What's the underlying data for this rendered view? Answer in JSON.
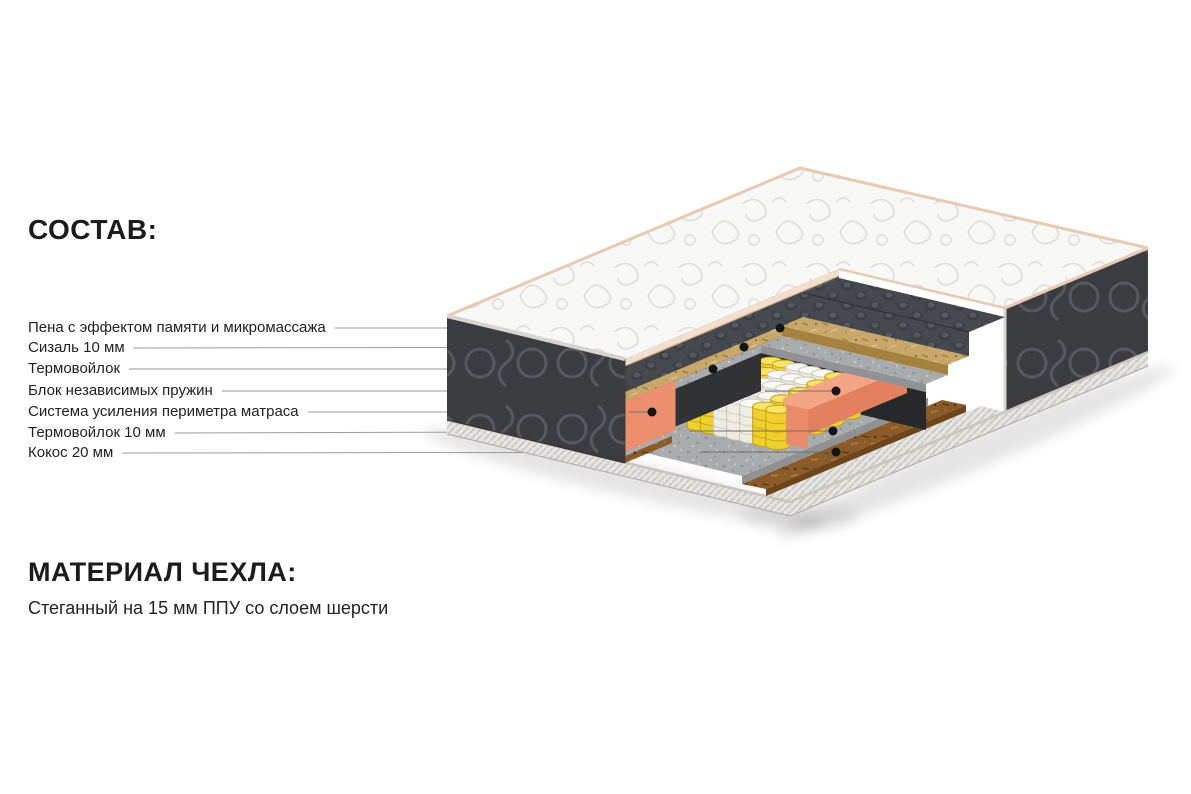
{
  "composition": {
    "title": "СОСТАВ:",
    "items": [
      {
        "label": "Пена с эффектом памяти и микромассажа",
        "layer": "memory-foam",
        "color": "#45484d"
      },
      {
        "label": "Сизаль 10 мм",
        "layer": "sisal",
        "color": "#c8a76b"
      },
      {
        "label": "Термовойлок",
        "layer": "thermo-felt",
        "color": "#a9abad"
      },
      {
        "label": "Блок независимых пружин",
        "layer": "pocket-springs",
        "color": "#f0d02e"
      },
      {
        "label": "Система усиления периметра матраса",
        "layer": "perimeter-foam",
        "color": "#ec8f6e"
      },
      {
        "label": "Термовойлок 10 мм",
        "layer": "thermo-felt-10",
        "color": "#a9abad"
      },
      {
        "label": "Кокос 20 мм",
        "layer": "coconut-coir",
        "color": "#8a5a28"
      }
    ]
  },
  "cover": {
    "title": "МАТЕРИАЛ ЧЕХЛА:",
    "subtitle": "Стеганный на 15 мм ППУ со слоем шерсти"
  },
  "palette": {
    "background": "#ffffff",
    "text": "#1e1e1e",
    "leader_line": "#9b9b9b",
    "dot": "#141414",
    "quilt_top": "#f8f8f6",
    "quilt_pattern": "#dedddb",
    "side_panel": "#3a3c40",
    "panel_stitch": "#56585d",
    "piping_pink": "#e7cab2",
    "piping_braid": "#e6e5e2",
    "memory_foam": "#45484d",
    "sisal": "#c8a76b",
    "felt": "#a9abad",
    "spring_yellow": "#f0d02e",
    "spring_white": "#efece4",
    "perimeter_coral": "#ec8f6e",
    "coconut": "#8a5a28"
  }
}
